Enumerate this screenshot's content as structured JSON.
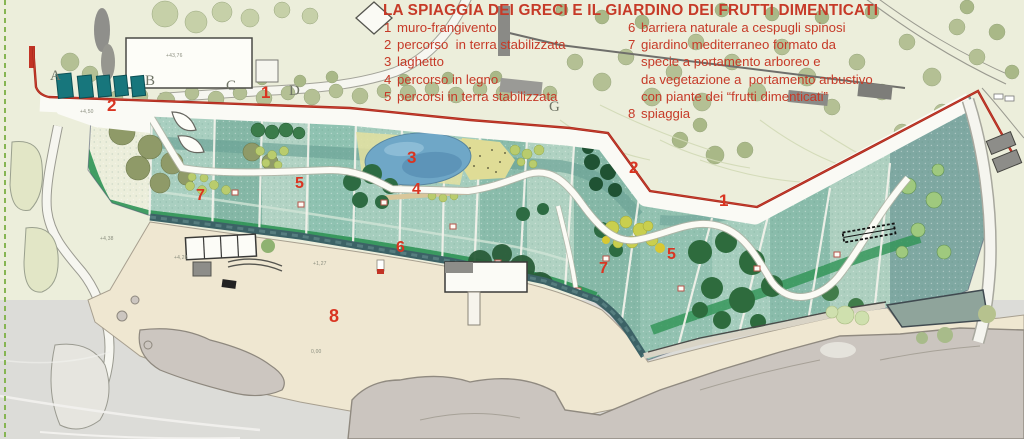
{
  "title": "LA SPIAGGIA DEI GRECI E IL GIARDINO DEI FRUTTI DIMENTICATI",
  "legend": {
    "left": [
      {
        "num": "1",
        "text": "muro-frangivento"
      },
      {
        "num": "2",
        "text": "percorso  in terra stabilizzata"
      },
      {
        "num": "3",
        "text": "laghetto"
      },
      {
        "num": "4",
        "text": "percorso in legno"
      },
      {
        "num": "5",
        "text": "percorsi in terra stabilizzata"
      }
    ],
    "right": [
      {
        "num": "6",
        "text": "barriera naturale a cespugli spinosi"
      },
      {
        "num": "7",
        "text": "giardino mediterraneo formato da"
      },
      {
        "num": "",
        "text": "specie a portamento arboreo e"
      },
      {
        "num": "",
        "text": "da vegetazione a  portamento arbustivo"
      },
      {
        "num": "",
        "text": "con piante dei “frutti dimenticati”"
      },
      {
        "num": "8",
        "text": "spiaggia"
      }
    ]
  },
  "map_numbers": [
    {
      "label": "2",
      "x": 107,
      "y": 97,
      "size": 17
    },
    {
      "label": "1",
      "x": 261,
      "y": 84,
      "size": 17
    },
    {
      "label": "7",
      "x": 196,
      "y": 188,
      "size": 16
    },
    {
      "label": "5",
      "x": 295,
      "y": 176,
      "size": 16
    },
    {
      "label": "3",
      "x": 407,
      "y": 149,
      "size": 17
    },
    {
      "label": "4",
      "x": 412,
      "y": 182,
      "size": 16
    },
    {
      "label": "2",
      "x": 629,
      "y": 159,
      "size": 17
    },
    {
      "label": "1",
      "x": 719,
      "y": 192,
      "size": 17
    },
    {
      "label": "6",
      "x": 396,
      "y": 240,
      "size": 16
    },
    {
      "label": "5",
      "x": 667,
      "y": 247,
      "size": 16
    },
    {
      "label": "7",
      "x": 599,
      "y": 261,
      "size": 16
    },
    {
      "label": "8",
      "x": 329,
      "y": 307,
      "size": 18
    }
  ],
  "area_letters": [
    {
      "label": "A",
      "x": 50,
      "y": 69
    },
    {
      "label": "B",
      "x": 145,
      "y": 74
    },
    {
      "label": "C",
      "x": 226,
      "y": 79
    },
    {
      "label": "D",
      "x": 289,
      "y": 84
    },
    {
      "label": "G",
      "x": 549,
      "y": 100
    }
  ],
  "elevation_labels": [
    {
      "label": "+43,76",
      "x": 166,
      "y": 54
    },
    {
      "label": "+4,50",
      "x": 80,
      "y": 110
    },
    {
      "label": "+4,38",
      "x": 100,
      "y": 237
    },
    {
      "label": "+4,28",
      "x": 174,
      "y": 256
    },
    {
      "label": "+1,27",
      "x": 313,
      "y": 262
    },
    {
      "label": "0,00",
      "x": 311,
      "y": 350
    }
  ],
  "palette": {
    "legend_red": "#c63a28",
    "number_red": "#d93522",
    "wall_red": "#a8291c",
    "garden_teal": "#9ccabb",
    "lake_blue": "#6fa7c7",
    "sand": "#efe7d1",
    "sea": "#dcdcd8",
    "hillside": "#eceedb",
    "promenade_dark": "#3c6266",
    "cabin_teal": "#17767c"
  }
}
